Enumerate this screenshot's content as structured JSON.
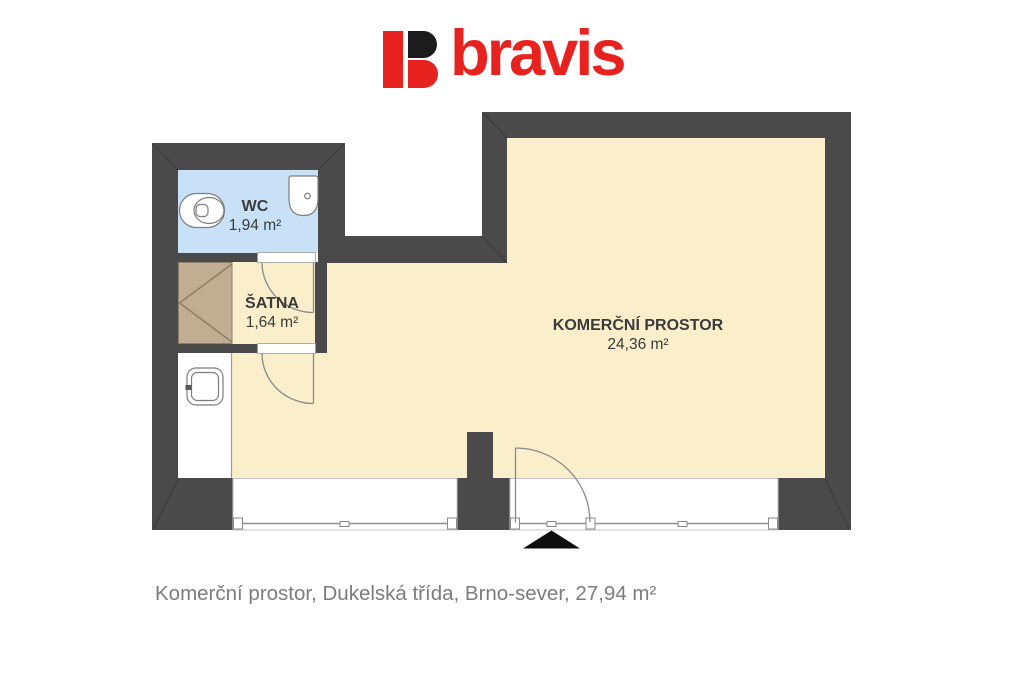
{
  "brand": {
    "name": "bravis"
  },
  "floorplan": {
    "rooms": [
      {
        "name": "WC",
        "area": "1,94 m²"
      },
      {
        "name": "ŠATNA",
        "area": "1,64 m²"
      },
      {
        "name": "KOMERČNÍ PROSTOR",
        "area": "24,36 m²"
      }
    ],
    "fixtures": [
      "toilet",
      "washbasin",
      "wardrobe",
      "kitchen-sink"
    ],
    "markers": [
      "entrance-arrow"
    ]
  },
  "caption": "Komerční prostor, Dukelská třída, Brno-sever, 27,94 m²",
  "colors": {
    "wall": "#4a4a4a",
    "floor": "#faeecb",
    "wcfloor": "#c9e1f6",
    "wardrobe": "#c1ae92",
    "brand": "#e8221f",
    "markblack": "#1c1c1c",
    "label": "#3b3b3b",
    "caption": "#7c7c7c"
  }
}
